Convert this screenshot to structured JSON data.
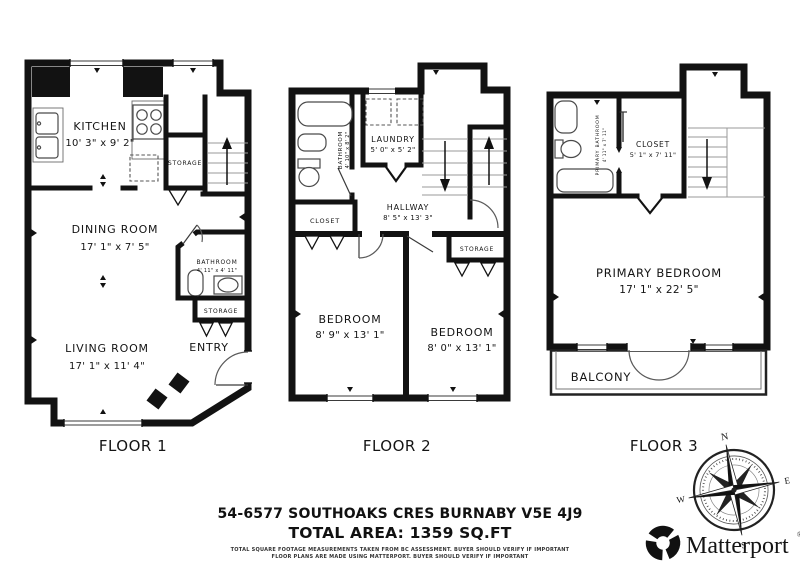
{
  "floor1": {
    "label": "FLOOR 1",
    "kitchen_name": "KITCHEN",
    "kitchen_dims": "10' 3\" x 9' 2\"",
    "storage1_name": "STORAGE",
    "dining_name": "DINING ROOM",
    "dining_dims": "17' 1\" x 7' 5\"",
    "bathroom_name": "BATHROOM",
    "bathroom_dims": "4' 11\" x 4' 11\"",
    "storage2_name": "STORAGE",
    "entry_name": "ENTRY",
    "living_name": "LIVING ROOM",
    "living_dims": "17' 1\" x 11' 4\""
  },
  "floor2": {
    "label": "FLOOR 2",
    "bathroom_name": "BATHROOM",
    "bathroom_dims": "4' 10\" x 8' 2\"",
    "laundry_name": "LAUNDRY",
    "laundry_dims": "5' 0\" x 5' 2\"",
    "hallway_name": "HALLWAY",
    "hallway_dims": "8' 5\" x 13' 3\"",
    "closet_name": "CLOSET",
    "storage_name": "STORAGE",
    "bedroom1_name": "BEDROOM",
    "bedroom1_dims": "8' 9\" x 13' 1\"",
    "bedroom2_name": "BEDROOM",
    "bedroom2_dims": "8' 0\" x 13' 1\""
  },
  "floor3": {
    "label": "FLOOR 3",
    "primary_bathroom_name": "PRIMARY BATHROOM",
    "primary_bathroom_dims": "4' 11\" x 7' 11\"",
    "closet_name": "CLOSET",
    "closet_dims": "5' 1\" x 7' 11\"",
    "primary_bedroom_name": "PRIMARY BEDROOM",
    "primary_bedroom_dims": "17' 1\" x 22' 5\"",
    "balcony_name": "BALCONY"
  },
  "footer": {
    "address": "54-6577 SOUTHOAKS CRES BURNABY V5E 4J9",
    "total_area": "TOTAL AREA: 1359 SQ.FT",
    "disclaimer_line1": "TOTAL SQUARE FOOTAGE MEASUREMENTS TAKEN FROM BC ASSESSMENT. BUYER SHOULD VERIFY IF IMPORTANT",
    "disclaimer_line2": "FLOOR PLANS ARE MADE USING MATTERPORT. BUYER SHOULD VERIFY IF IMPORTANT"
  },
  "compass": {
    "north": "N",
    "east": "E",
    "south": "S",
    "west": "W"
  },
  "brand": {
    "name": "Matterport",
    "registered": "®"
  }
}
